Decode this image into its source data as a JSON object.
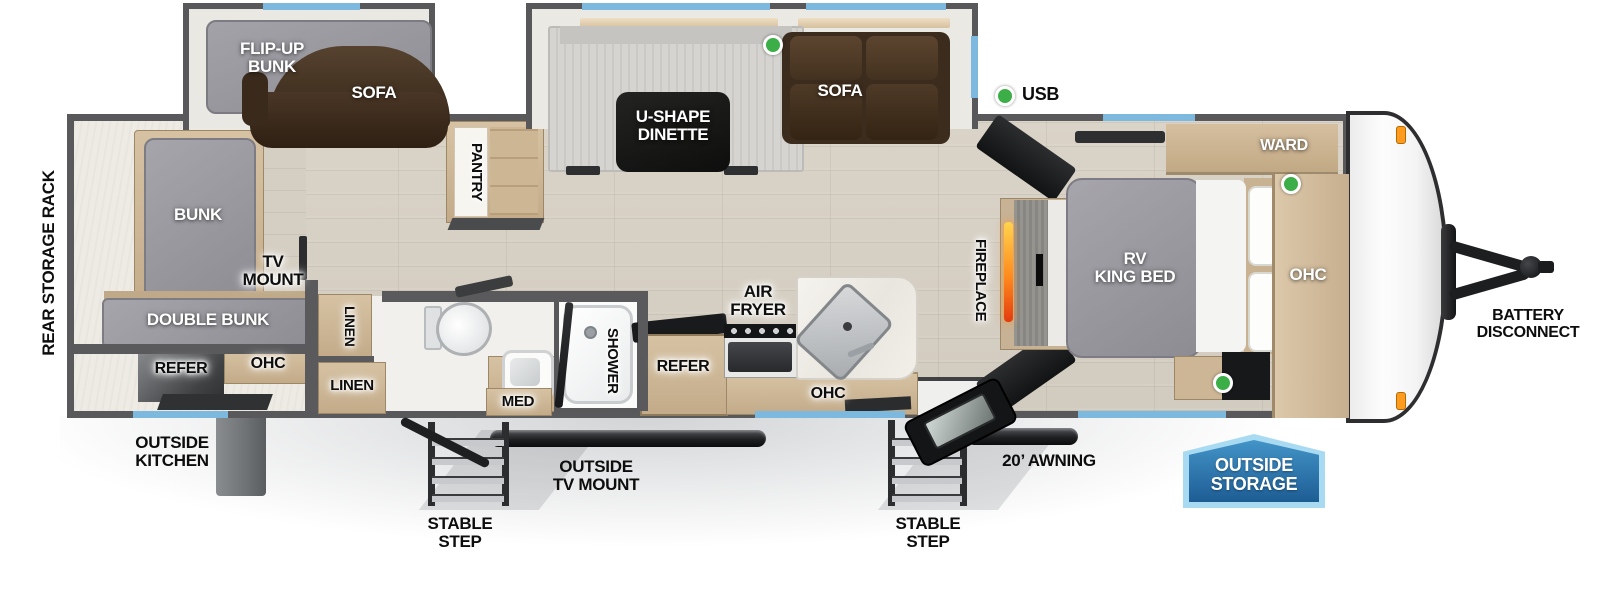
{
  "diagram": {
    "type": "rv-travel-trailer-floorplan",
    "legend": {
      "usb": "USB"
    },
    "exterior": {
      "rear_storage_rack": "REAR STORAGE RACK",
      "outside_kitchen": "OUTSIDE\nKITCHEN",
      "stable_step_left": "STABLE STEP",
      "stable_step_right": "STABLE STEP",
      "outside_tv_mount": "OUTSIDE\nTV MOUNT",
      "awning": "20’ AWNING",
      "outside_storage": "OUTSIDE\nSTORAGE",
      "battery_disconnect": "BATTERY\nDISCONNECT"
    },
    "bunk_room": {
      "flip_up_bunk": "FLIP-UP\nBUNK",
      "sofa": "SOFA",
      "bunk": "BUNK",
      "tv_mount": "TV\nMOUNT",
      "double_bunk": "DOUBLE BUNK",
      "refer": "REFER",
      "ohc": "OHC"
    },
    "living_area": {
      "u_shape_dinette": "U-SHAPE\nDINETTE",
      "sofa": "SOFA",
      "pantry": "PANTRY",
      "fireplace": "FIREPLACE"
    },
    "bathroom": {
      "linen_upper": "LINEN",
      "linen_lower": "LINEN",
      "med": "MED",
      "shower": "SHOWER"
    },
    "kitchen": {
      "air_fryer": "AIR\nFRYER",
      "refer": "REFER",
      "ohc": "OHC"
    },
    "bedroom": {
      "ward": "WARD",
      "rv_king_bed": "RV\nKING BED",
      "ohc": "OHC"
    },
    "colors": {
      "window_blue": "#7db8de",
      "usb_green": "#3cae47",
      "badge_blue_fill": "#2674ae",
      "badge_blue_border": "#a8dbf2",
      "flame_orange": "#ff8a1e",
      "wall_gray": "#5a5a5c",
      "wood_tan": "#cbb394",
      "floor_tan": "#d7d0c4"
    }
  }
}
